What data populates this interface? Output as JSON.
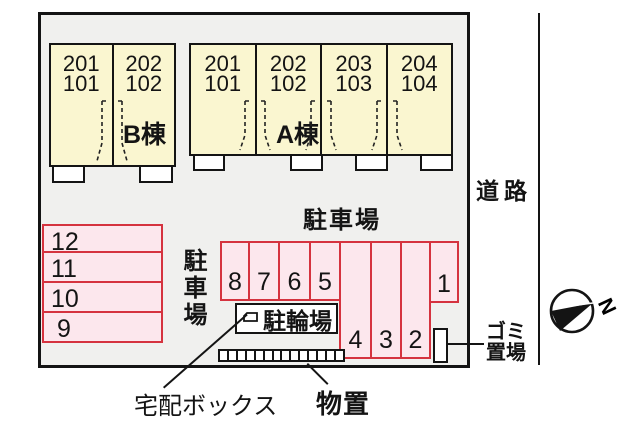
{
  "site": {
    "buildings": {
      "b": {
        "label": "B棟",
        "units": [
          {
            "upper": "201",
            "lower": "101"
          },
          {
            "upper": "202",
            "lower": "102"
          }
        ]
      },
      "a": {
        "label": "A棟",
        "units": [
          {
            "upper": "201",
            "lower": "101"
          },
          {
            "upper": "202",
            "lower": "102"
          },
          {
            "upper": "203",
            "lower": "103"
          },
          {
            "upper": "204",
            "lower": "104"
          }
        ]
      }
    },
    "parking": {
      "label_top": "駐車場",
      "label_left_vertical": "駐車場",
      "left_column_spaces": [
        "12",
        "11",
        "10",
        "9"
      ],
      "middle_row_spaces": [
        "8",
        "7",
        "6",
        "5"
      ],
      "tall_column_spaces": [
        "4",
        "3",
        "2"
      ],
      "corner_space": "1"
    },
    "bicycle_parking_label": "駐輪場",
    "storage_unit_count": 14,
    "labels": {
      "road": "道路",
      "garbage_line1": "ゴミ",
      "garbage_line2": "置場",
      "delivery_box": "宅配ボックス",
      "storage": "物置"
    },
    "compass": {
      "north_label": "N"
    }
  },
  "colors": {
    "building_fill": "#faf6d0",
    "parking_fill": "#fce7ed",
    "parking_border": "#d5333f",
    "line": "#141414",
    "site_background": "#f0f0ee"
  }
}
